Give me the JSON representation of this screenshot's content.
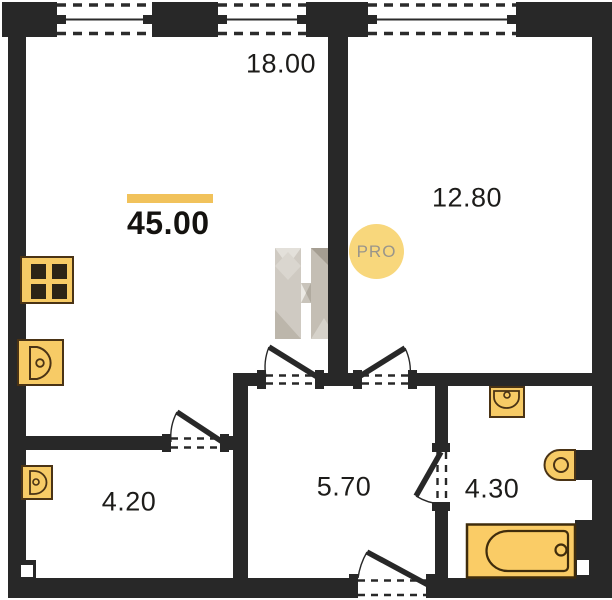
{
  "plan": {
    "title": "apartment floor plan",
    "total": {
      "area": "45.00"
    },
    "badge": {
      "label": "PRO"
    },
    "watermark": {
      "letter": "H"
    },
    "rooms": [
      {
        "name": "living-room-kitchen",
        "area": "18.00"
      },
      {
        "name": "bedroom",
        "area": "12.80"
      },
      {
        "name": "storage-room",
        "area": "4.20"
      },
      {
        "name": "hallway",
        "area": "5.70"
      },
      {
        "name": "bathroom",
        "area": "4.30"
      }
    ],
    "fixtures": [
      "stove-icon",
      "kitchen-sink-icon",
      "storage-sink-icon",
      "bathroom-sink-icon",
      "toilet-icon",
      "bathtub-icon"
    ],
    "windows_count": 3,
    "doors_count": 5,
    "colors": {
      "wall": "#282828",
      "fixture_fill": "#F7CB66",
      "bathtub_fill": "#FACC66",
      "fixture_stroke": "#4a3315",
      "accent_bar": "#F1C25B",
      "badge_fill": "#F8D77C",
      "badge_text": "#99958b",
      "label_text": "#1d1c1a"
    }
  }
}
